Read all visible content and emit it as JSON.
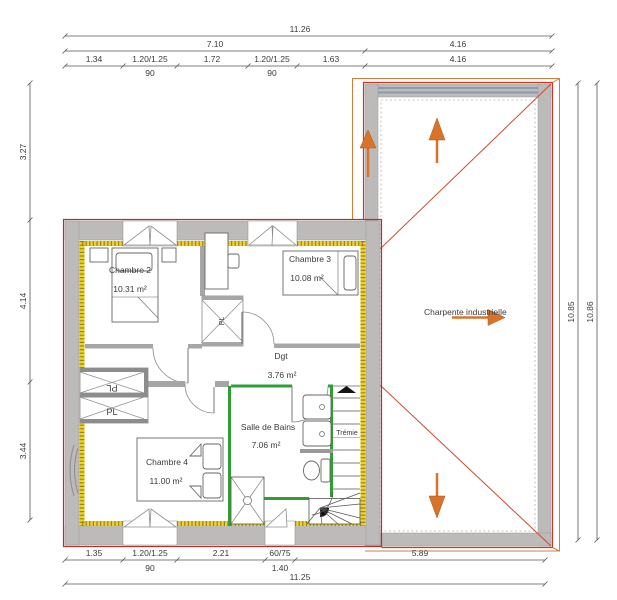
{
  "plan": {
    "rooms": {
      "chambre2": {
        "name": "Chambre 2",
        "area": "10.31 m²"
      },
      "chambre3": {
        "name": "Chambre 3",
        "area": "10.08 m²"
      },
      "chambre4": {
        "name": "Chambre 4",
        "area": "11.00 m²"
      },
      "dgt": {
        "name": "Dgt",
        "area": "3.76 m²"
      },
      "salle_de_bains": {
        "name": "Salle de Bains",
        "area": "7.06 m²"
      },
      "tremie": {
        "name": "Trémie"
      },
      "charpente": {
        "name": "Charpente industrielle"
      }
    },
    "closets": {
      "pl_middle": "PL",
      "pl_upper": "PL",
      "pl_lower": "PL"
    },
    "dimensions": {
      "top": {
        "total": "11.26",
        "span_left": "7.10",
        "span_right": "4.16",
        "segments": [
          "1.34",
          "1.20/1.25",
          "1.72",
          "1.20/1.25",
          "1.63",
          "4.16"
        ],
        "sills": [
          "90",
          "90"
        ]
      },
      "left": [
        "3.27",
        "4.14",
        "3.44"
      ],
      "right": [
        "10.85",
        "10.86"
      ],
      "bottom": {
        "segments": [
          "1.35",
          "1.20/1.25",
          "2.21",
          "60/75",
          "5.89"
        ],
        "sill": "90",
        "window_height": "1.40",
        "total": "11.25"
      }
    },
    "colors": {
      "wall_gray": "#bdbaba",
      "insulation_yellow": "#eed224",
      "partition_green": "#2f9e33",
      "outline_red": "#c5392b",
      "frame_orange": "#cf7e3e",
      "arrow_orange": "#d9732a",
      "beam_blue": "#8a9bac"
    }
  }
}
